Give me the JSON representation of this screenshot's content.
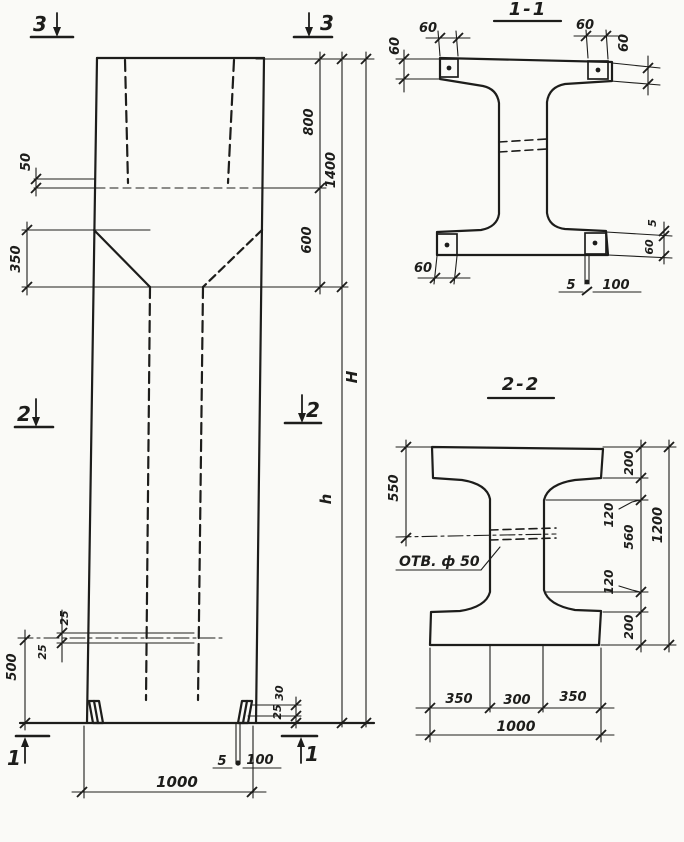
{
  "page": {
    "background": "#fafaf7",
    "ink": "#1d1d1b"
  },
  "elevation": {
    "markers": {
      "top_left": "3",
      "top_right": "3",
      "mid_left": "2",
      "mid_right": "2",
      "bottom_left": "1",
      "bottom_right": "1"
    },
    "dims": {
      "ledge_depth": "50",
      "taper_height": "350",
      "pocket_depth": "800",
      "upper_total": "1400",
      "neck_height": "600",
      "total_height": "H",
      "shaft_height": "h",
      "hole_upper": "25",
      "hole_lower": "25",
      "hole_elevation": "500",
      "foot_upper": "30",
      "foot_lower": "25",
      "base_plate_thickness": "5",
      "base_plate_width": "100",
      "column_width": "1000"
    }
  },
  "section1": {
    "title": "1-1",
    "dims": {
      "plate_top_left": "60",
      "plate_left_height": "60",
      "plate_top_right": "60",
      "plate_right_height": "60",
      "plate_bottom_left": "60",
      "right_gap": "5",
      "right_plate_height": "60",
      "anchor_thickness": "5",
      "anchor_width": "100"
    }
  },
  "section2": {
    "title": "2-2",
    "hole_label": "ОТВ. ф 50",
    "dims": {
      "top_to_hole": "550",
      "top_flange": "200",
      "fillet_top": "120",
      "web_height": "560",
      "fillet_bottom": "120",
      "bottom_flange": "200",
      "overall_height": "1200",
      "bottom_left": "350",
      "bottom_mid": "300",
      "bottom_right": "350",
      "overall_width": "1000"
    }
  }
}
